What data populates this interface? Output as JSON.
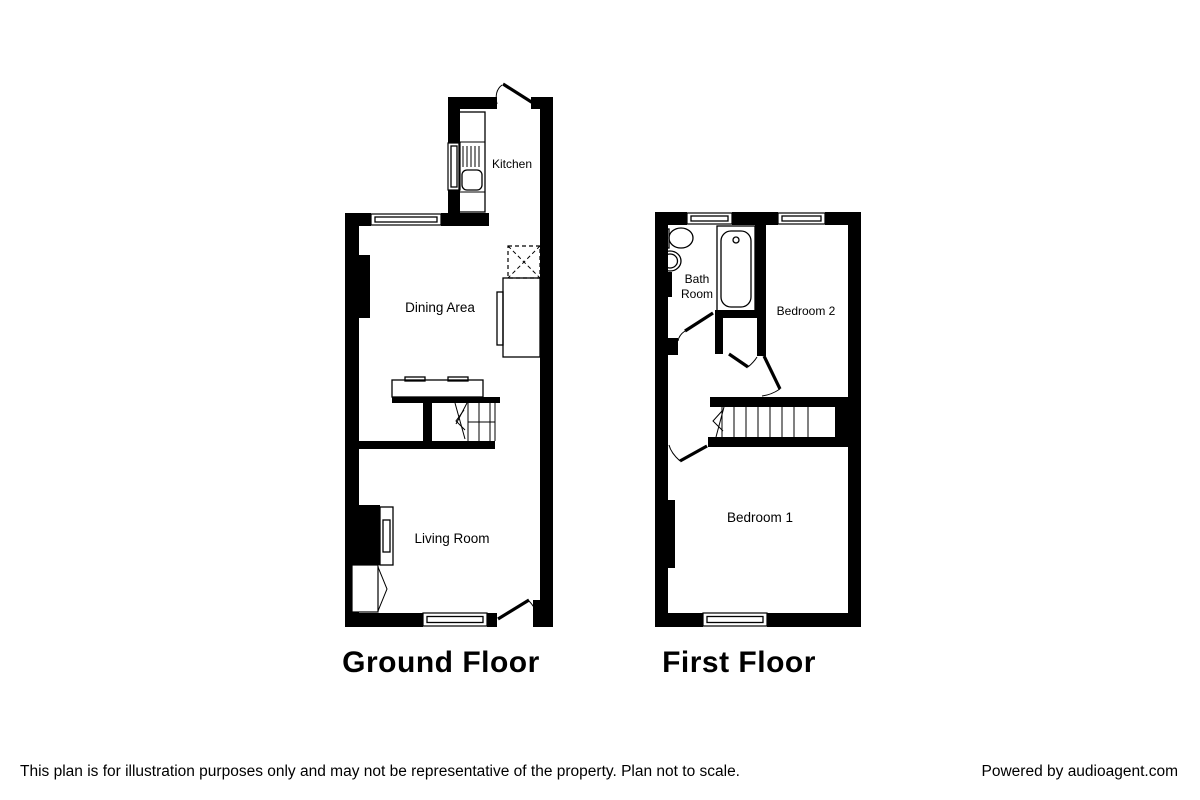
{
  "ground": {
    "title": "Ground Floor",
    "rooms": {
      "kitchen": "Kitchen",
      "dining": "Dining Area",
      "living": "Living Room"
    }
  },
  "first": {
    "title": "First Floor",
    "rooms": {
      "bath_line1": "Bath",
      "bath_line2": "Room",
      "bedroom2": "Bedroom 2",
      "bedroom1": "Bedroom 1"
    }
  },
  "footer": {
    "disclaimer": "This plan is for illustration purposes only and may not be representative of the property. Plan not to scale.",
    "powered_by": "Powered by audioagent.com"
  },
  "colors": {
    "walls": "#000000",
    "background": "#ffffff",
    "text": "#000000"
  }
}
